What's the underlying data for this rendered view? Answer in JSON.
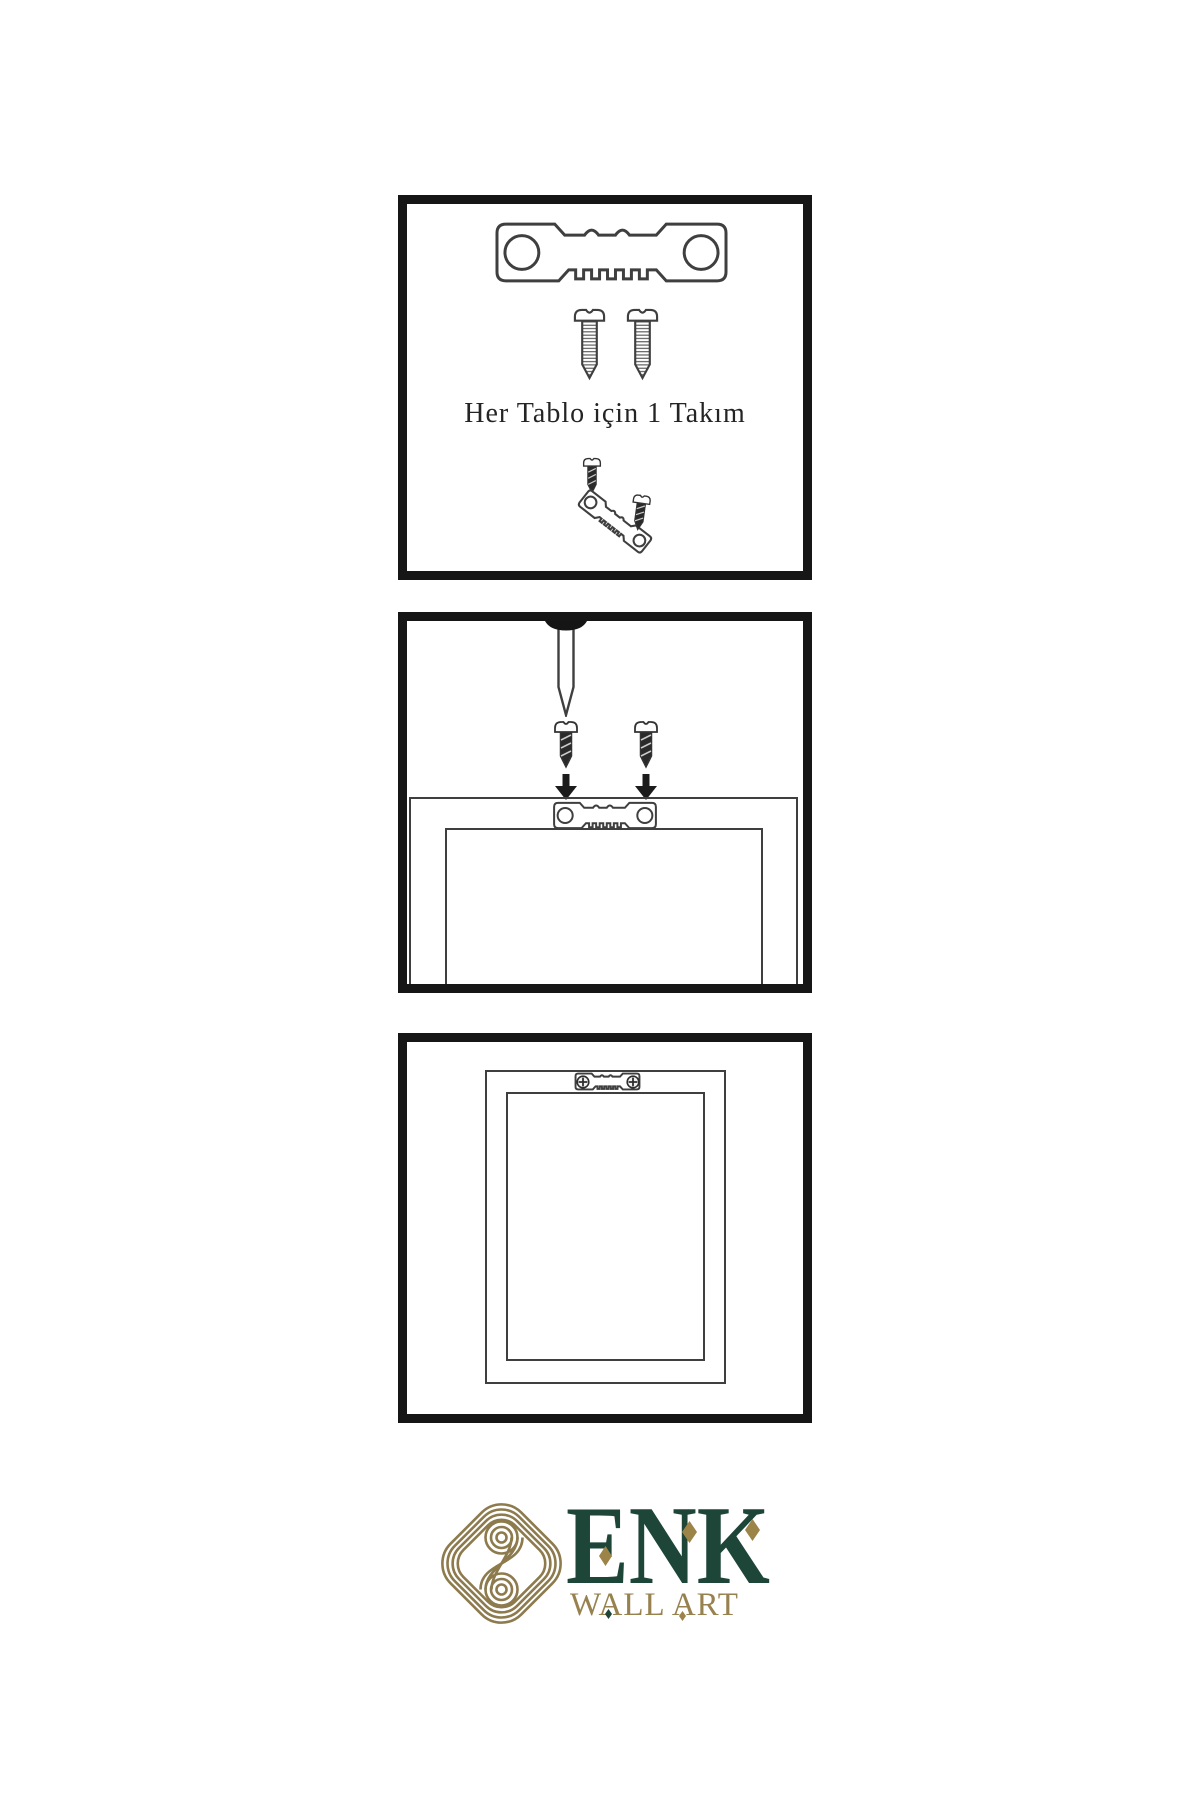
{
  "image": {
    "background": "#ffffff",
    "kind": "wall-art-hanging-instructions"
  },
  "colors": {
    "panel_border": "#161616",
    "outline": "#3f3f3f",
    "dark_hardware": "#2a2a2a",
    "logo_gold": "#8d7a4d",
    "logo_green": "#1d4538",
    "tagline_gold": "#97824f"
  },
  "step1": {
    "caption": "Her Tablo için 1 Takım",
    "icons": [
      "sawtooth-hanger",
      "screw",
      "screw",
      "screw",
      "tilted-sawtooth-hanger",
      "screw"
    ]
  },
  "step2": {
    "icons": [
      "wall-nail",
      "screw",
      "screw",
      "down-arrow",
      "down-arrow",
      "frame-back-with-sawtooth-hanger"
    ]
  },
  "step3": {
    "icons": [
      "hanging-frame-with-mounted-sawtooth-hanger"
    ]
  },
  "logo": {
    "brand": "ENK",
    "tagline": "WALL ART",
    "symbol": "interlocked-knot"
  }
}
